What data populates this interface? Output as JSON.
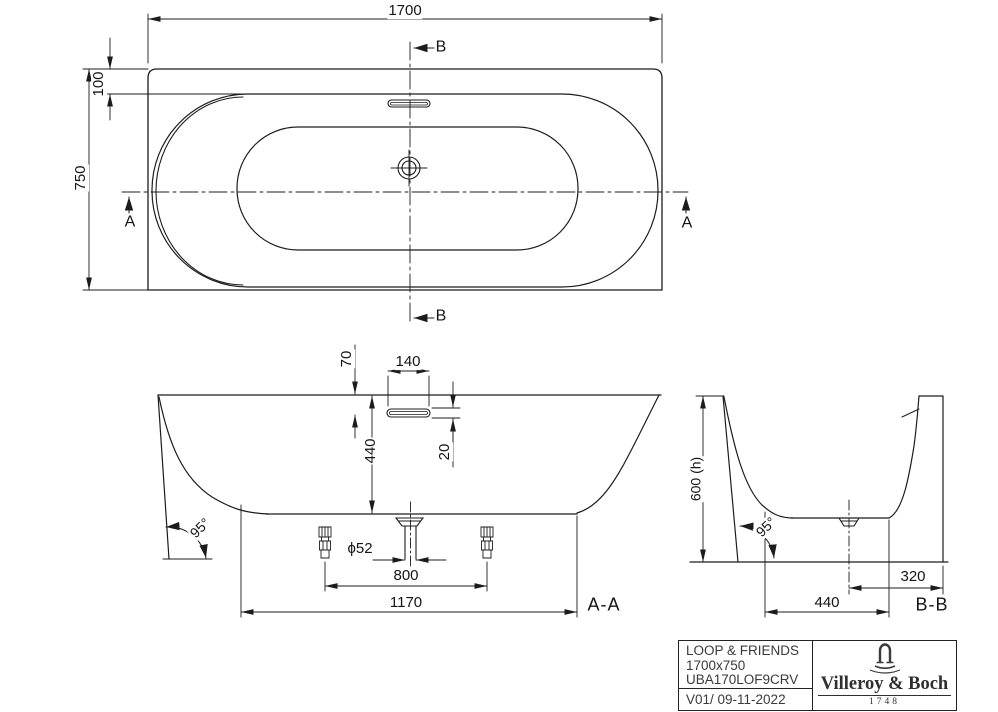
{
  "colors": {
    "line": "#1c1c1c",
    "text": "#141414",
    "background": "#ffffff"
  },
  "top_view": {
    "dim_width": "1700",
    "dim_height": "750",
    "dim_rim_offset": "100",
    "section_label_a": "A",
    "section_label_b": "B"
  },
  "section_aa": {
    "label": "A-A",
    "dim_rim_to_overflow": "70",
    "dim_overflow_width": "140",
    "dim_depth": "440",
    "dim_overflow_slot": "20",
    "dim_drain_diameter": "ϕ52",
    "dim_feet_spacing": "800",
    "dim_base_length": "1170",
    "angle_skirt": "95°"
  },
  "section_bb": {
    "label": "B-B",
    "dim_height": "600 (h)",
    "dim_drain_to_back": "320",
    "dim_base_width": "440",
    "angle_skirt": "95°"
  },
  "title_block": {
    "product_name": "LOOP & FRIENDS",
    "dimensions": "1700x750",
    "article_number": "UBA170LOF9CRV",
    "version": "V01/ 09-11-2022",
    "brand": "Villeroy & Boch",
    "brand_year": "1748"
  }
}
